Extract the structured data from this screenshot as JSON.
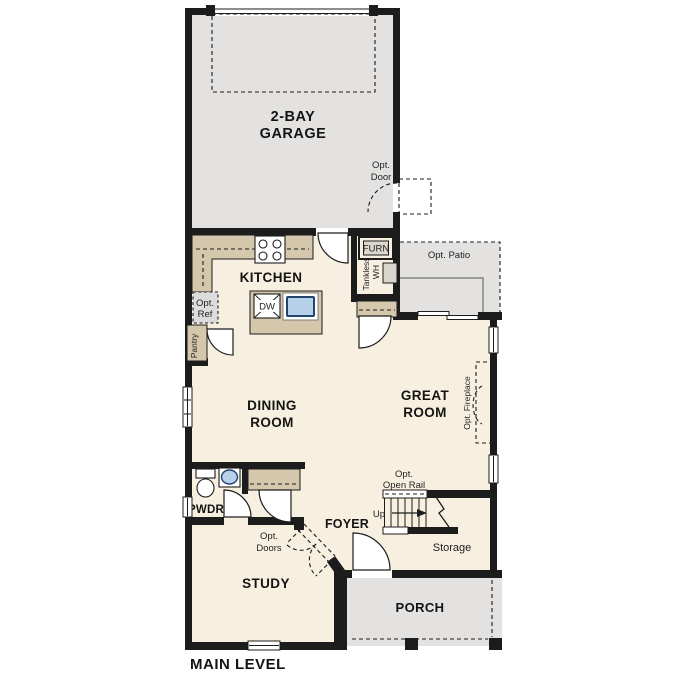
{
  "plan_title": "MAIN LEVEL",
  "rooms": {
    "garage": {
      "line1": "2-BAY",
      "line2": "GARAGE"
    },
    "kitchen": {
      "label": "KITCHEN"
    },
    "dining": {
      "line1": "DINING",
      "line2": "ROOM"
    },
    "great": {
      "line1": "GREAT",
      "line2": "ROOM"
    },
    "powder": {
      "label": "PWDR"
    },
    "foyer": {
      "label": "FOYER"
    },
    "study": {
      "label": "STUDY"
    },
    "porch": {
      "label": "PORCH"
    },
    "storage": {
      "label": "Storage"
    }
  },
  "features": {
    "garage_opt_door": {
      "line1": "Opt.",
      "line2": "Door"
    },
    "opt_patio": {
      "label": "Opt. Patio"
    },
    "furnace": {
      "label": "FURN"
    },
    "water_heater": {
      "line1": "Tankless",
      "line2": "WH"
    },
    "opt_ref": {
      "line1": "Opt.",
      "line2": "Ref"
    },
    "pantry": {
      "label": "Pantry"
    },
    "dishwasher": {
      "label": "DW"
    },
    "opt_fireplace": {
      "label": "Opt. Fireplace"
    },
    "opt_doors": {
      "line1": "Opt.",
      "line2": "Doors"
    },
    "stairs": {
      "up": "Up",
      "opt_rail_line1": "Opt.",
      "opt_rail_line2": "Open Rail"
    }
  },
  "colors": {
    "wall": "#1c1c1c",
    "floor": "#f7f0e1",
    "concrete": "#e3e2e1",
    "cabinet": "#d5c7ac",
    "fixture_blue": "#b7d1ea",
    "text": "#141414"
  }
}
